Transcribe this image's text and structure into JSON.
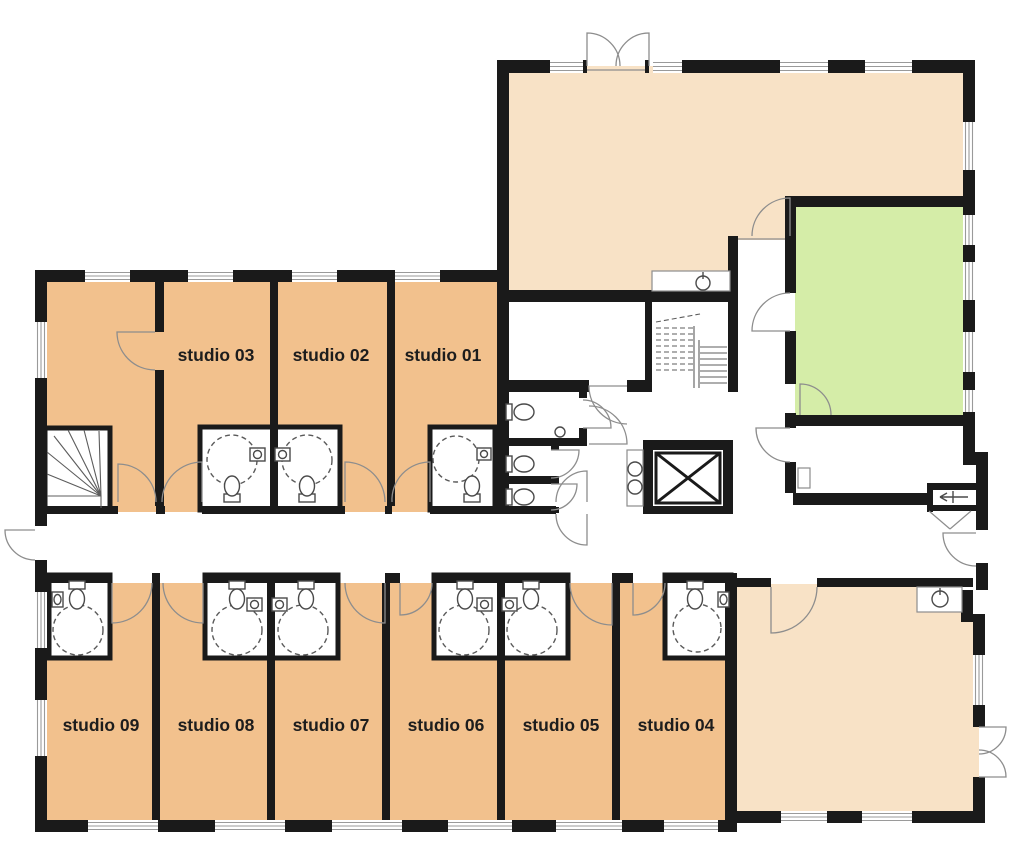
{
  "rooms": {
    "studios": [
      {
        "label": "studio 01"
      },
      {
        "label": "studio 02"
      },
      {
        "label": "studio 03"
      },
      {
        "label": "studio 04"
      },
      {
        "label": "studio 05"
      },
      {
        "label": "studio 06"
      },
      {
        "label": "studio 07"
      },
      {
        "label": "studio 08"
      },
      {
        "label": "studio 09"
      }
    ],
    "unlabeled": [
      "lounge-room-top-left",
      "common-room-top",
      "green-room",
      "common-room-bottom-right",
      "entrance-hall",
      "storage-room",
      "wc-rooms",
      "corridor"
    ]
  },
  "colors": {
    "studio_room": "#f2c18d",
    "common_room": "#f8e2c6",
    "green_room": "#d5eda8",
    "wall": "#1a1a1a",
    "door_arc": "#8d8d8d",
    "window_line": "#9a9a9a",
    "fixture_line": "#4a4a4a",
    "label_text": "#1d1d1d",
    "background": "#ffffff"
  },
  "symbols": {
    "toilet": "toilet-icon",
    "shower": "dashed-circle shower-icon",
    "sink": "sink-icon",
    "double_sink": "double-sink-icon",
    "elevator": "x-box elevator-icon",
    "straight_stairs": "stairs-icon",
    "winding_stairs": "winding-stairs-icon",
    "door_swing": "quarter-arc door-swing",
    "window": "triple-line window-glazing",
    "entrance": "entrance-arrow-icon"
  }
}
